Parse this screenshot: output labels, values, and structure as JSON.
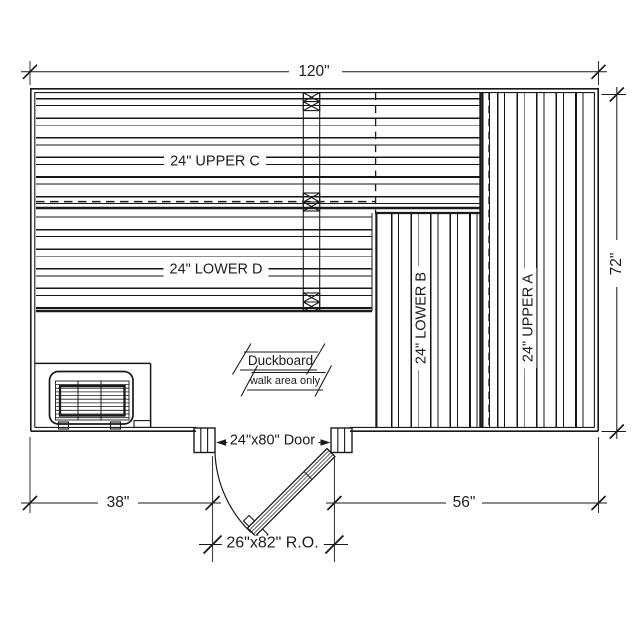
{
  "plan": {
    "dimensions": {
      "width": "120\"",
      "depth": "72\"",
      "wall_to_door": "38\"",
      "door_to_wall": "56\"",
      "rough_opening": "26\"x82\" R.O."
    },
    "door": {
      "label": "24\"x80\" Door"
    },
    "benches": {
      "upper_c": "24\" UPPER C",
      "lower_d": "24\" LOWER D",
      "lower_b": "24\" LOWER B",
      "upper_a": "24\" UPPER A"
    },
    "duckboard": {
      "title": "Duckboard",
      "note": "walk area only"
    },
    "colors": {
      "line": "#1a1a1a",
      "hidden_line": "#777777",
      "background": "#ffffff"
    }
  }
}
